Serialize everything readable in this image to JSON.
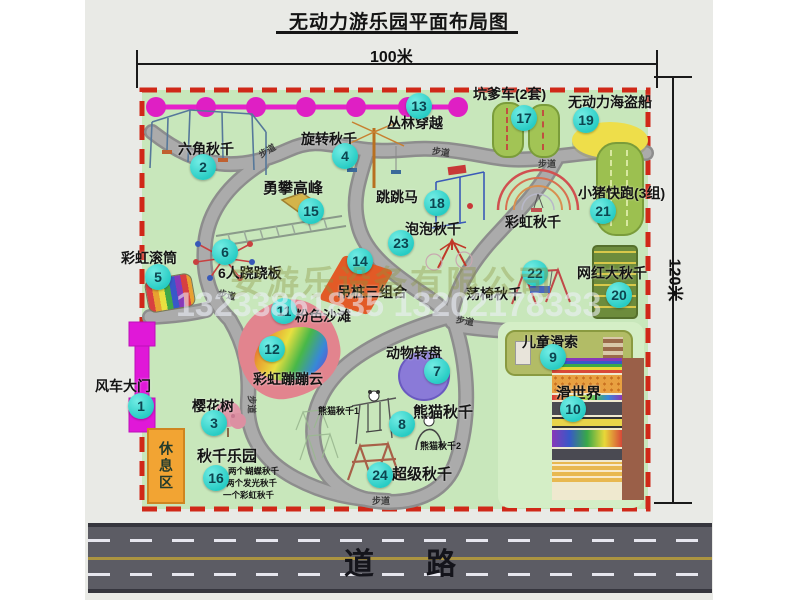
{
  "title": "无动力游乐园平面布局图",
  "dim_top": "100米",
  "dim_right": "120米",
  "road_label": "道路",
  "walkway_label": "步道",
  "watermark": {
    "line1": "安游乐设备有限公司",
    "line2": "13233861835 13202178333"
  },
  "colors": {
    "map_green": "#c8e7bb",
    "border_red": "#d02818",
    "badge_cyan": "#27ccc4",
    "gate_magenta": "#e018d8",
    "road_gray": "#5c5c64"
  },
  "attractions": [
    {
      "num": "1",
      "name": "风车大门"
    },
    {
      "num": "2",
      "name": "六角秋千"
    },
    {
      "num": "3",
      "name": "樱花树"
    },
    {
      "num": "4",
      "name": "旋转秋千"
    },
    {
      "num": "5",
      "name": "彩虹滚筒"
    },
    {
      "num": "6",
      "name": "6人跷跷板"
    },
    {
      "num": "7",
      "name": "动物转盘"
    },
    {
      "num": "8",
      "name": "熊猫秋千"
    },
    {
      "num": "9",
      "name": "儿童滑索"
    },
    {
      "num": "10",
      "name": "滑世界"
    },
    {
      "num": "11",
      "name": "粉色沙滩"
    },
    {
      "num": "12",
      "name": "彩虹蹦蹦云"
    },
    {
      "num": "13",
      "name": "丛林穿越"
    },
    {
      "num": "14",
      "name": "吊桩三组合"
    },
    {
      "num": "15",
      "name": "勇攀高峰"
    },
    {
      "num": "16",
      "name": "秋千乐园"
    },
    {
      "num": "17",
      "name": "坑爹车(2套)"
    },
    {
      "num": "18",
      "name": "跳跳马"
    },
    {
      "num": "19",
      "name": "无动力海盗船"
    },
    {
      "num": "20",
      "name": "网红大秋千"
    },
    {
      "num": "21",
      "name": "小猪快跑(3组)"
    },
    {
      "num": "22",
      "name": "荡椅秋千"
    },
    {
      "num": "23",
      "name": "泡泡秋千"
    },
    {
      "num": "24",
      "name": "超级秋千"
    }
  ],
  "annotations": {
    "rest_area": "休息区",
    "rainbow_swing": "彩虹秋千",
    "panda_swing_1": "熊猫秋千1",
    "panda_swing_2": "熊猫秋千2",
    "swing_park_items": [
      "两个蝴蝶秋千",
      "两个发光秋千",
      "一个彩虹秋千"
    ]
  }
}
